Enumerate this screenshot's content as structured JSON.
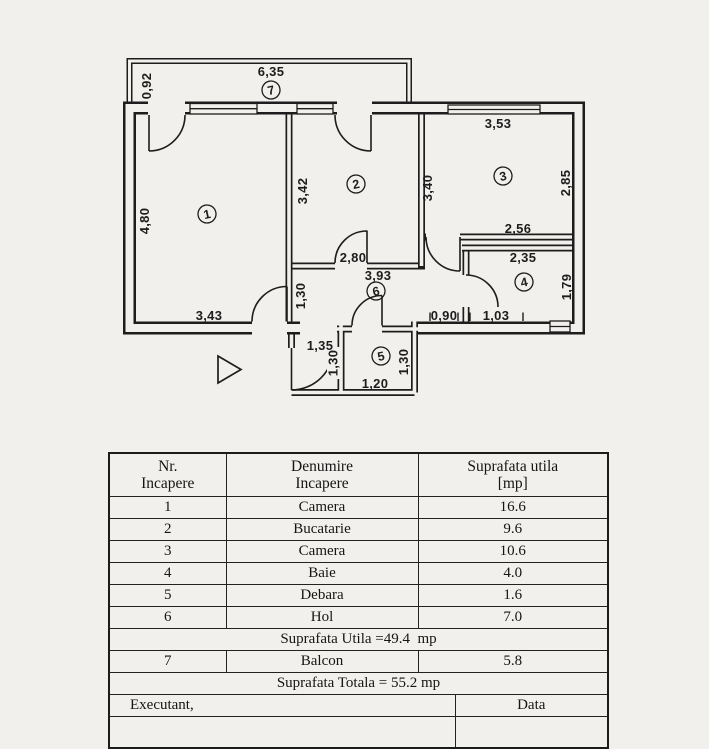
{
  "colors": {
    "bg": "#f1f0ec",
    "ink": "#1d1d1d"
  },
  "floor_plan": {
    "rooms": [
      {
        "num": "1"
      },
      {
        "num": "2"
      },
      {
        "num": "3"
      },
      {
        "num": "4"
      },
      {
        "num": "5"
      },
      {
        "num": "6"
      },
      {
        "num": "7"
      }
    ],
    "dims": {
      "d635": "6,35",
      "d092": "0,92",
      "d353": "3,53",
      "d285": "2,85",
      "d342": "3,42",
      "d340": "3,40",
      "d480": "4,80",
      "d256": "2,56",
      "d235": "2,35",
      "d179": "1,79",
      "d280": "2,80",
      "d393": "3,93",
      "d130a": "1,30",
      "d343": "3,43",
      "d090": "0,90",
      "d103": "1,03",
      "d135": "1,35",
      "d130b": "1,30",
      "d130c": "1,30",
      "d120": "1,20"
    }
  },
  "table": {
    "headers": {
      "col1a": "Nr.",
      "col1b": "Incapere",
      "col2a": "Denumire",
      "col2b": "Incapere",
      "col3a": "Suprafata utila",
      "col3b": "[mp]"
    },
    "rows": [
      {
        "nr": "1",
        "name": "Camera",
        "area": "16.6"
      },
      {
        "nr": "2",
        "name": "Bucatarie",
        "area": "9.6"
      },
      {
        "nr": "3",
        "name": "Camera",
        "area": "10.6"
      },
      {
        "nr": "4",
        "name": "Baie",
        "area": "4.0"
      },
      {
        "nr": "5",
        "name": "Debara",
        "area": "1.6"
      },
      {
        "nr": "6",
        "name": "Hol",
        "area": "7.0"
      }
    ],
    "suprafata_utila": "Suprafata Utila =49.4  mp",
    "balcon": {
      "nr": "7",
      "name": "Balcon",
      "area": "5.8"
    },
    "suprafata_totala": "Suprafata Totala = 55.2 mp",
    "executant": "Executant,",
    "data_label": "Data"
  }
}
